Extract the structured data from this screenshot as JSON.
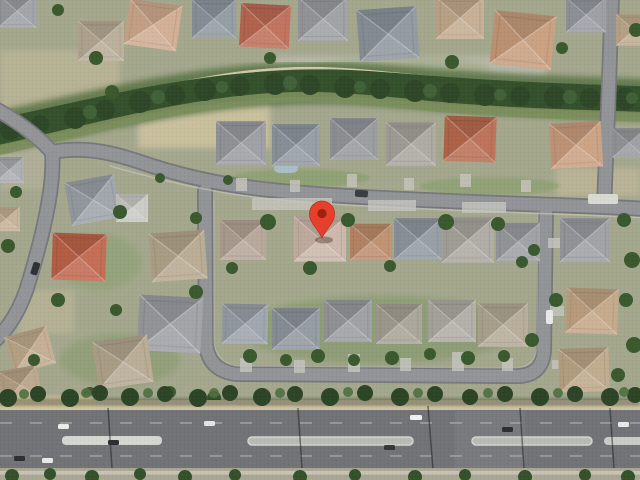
{
  "map": {
    "view_type": "satellite-aerial",
    "scene": "Aerial satellite view of a suburban residential neighborhood with curving streets, shingle and tile rooftops, dense tree belts, and a multi-lane arterial road along the bottom edge. A red location pin marks a house near the center.",
    "marker": {
      "label": "dropped-pin",
      "x": 322,
      "y": 238,
      "transform": "translate(322,238)",
      "color": "#E5402C",
      "stroke": "#C2301F",
      "dot_color": "#9E2110",
      "shadow_color": "rgba(40,20,10,0.35)"
    },
    "palette": {
      "ground": "#A3A78C",
      "residential_road": "#929498",
      "road_casing": "#76787C",
      "arterial_road": "#717376",
      "median": "#D6D6D0",
      "tree_dark": "#2F4A28",
      "tree_mid": "#3A5A2E",
      "tree_light": "#4E7040",
      "sidewalk": "#CDC3A4",
      "roof_gray": "#96989D",
      "roof_tan": "#C2A98C",
      "roof_red": "#BD6952"
    }
  }
}
